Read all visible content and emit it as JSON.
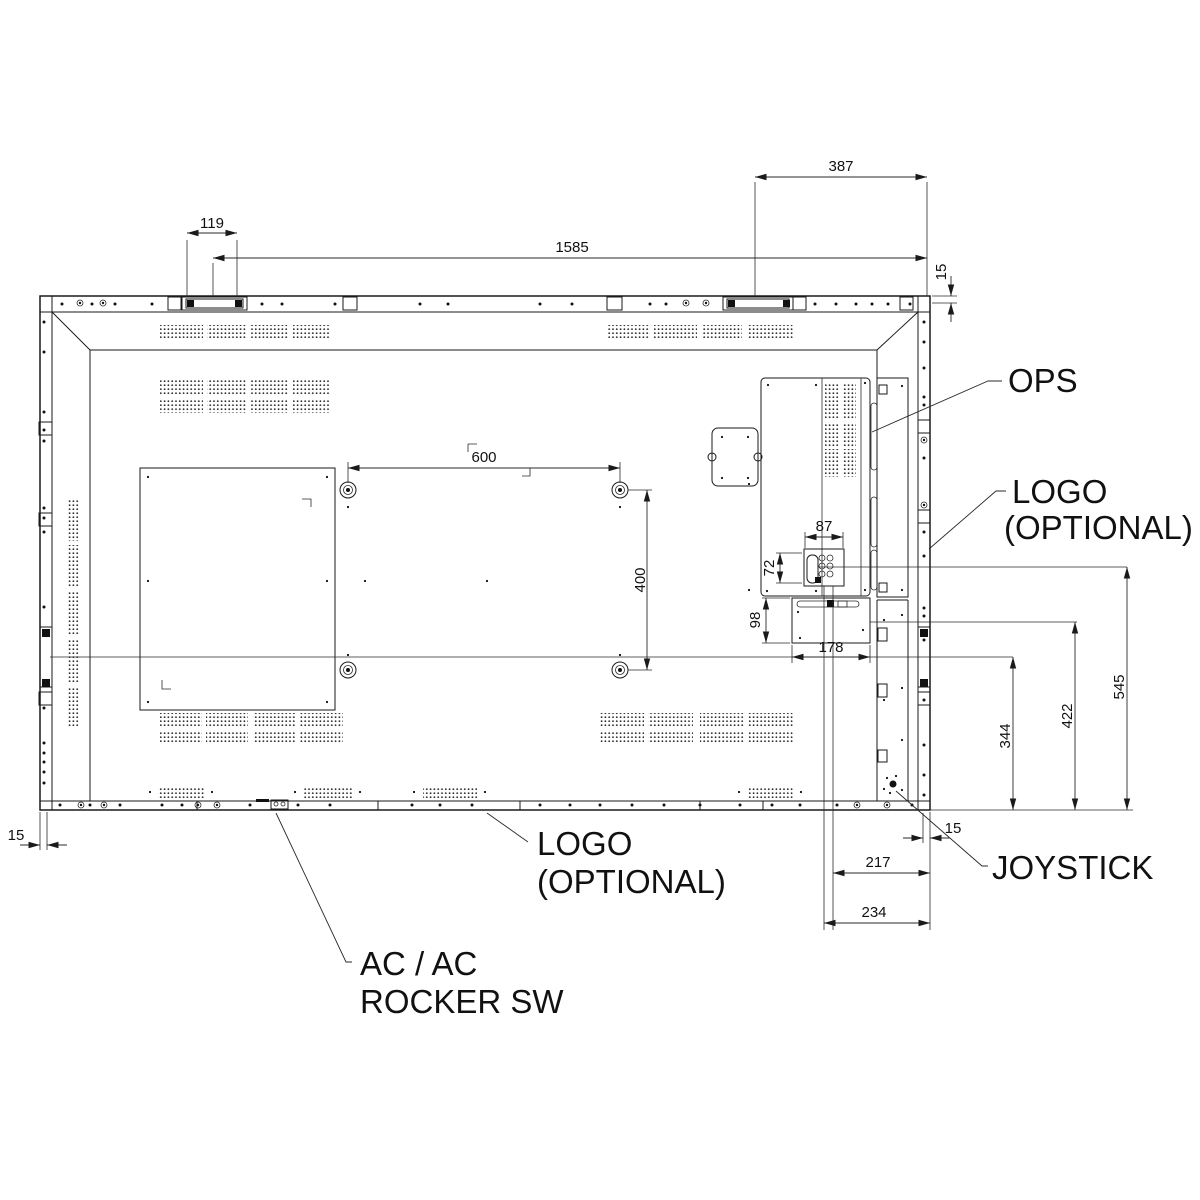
{
  "drawing": {
    "background": "#ffffff",
    "line_color": "#1a1a1a",
    "dimensions": {
      "handle_width": "119",
      "overall_width": "1585",
      "top_right_offset": "387",
      "top_edge_margin": "15",
      "vesa_horizontal": "600",
      "vesa_vertical": "400",
      "control_width": "87",
      "control_height": "72",
      "box_height": "98",
      "box_width": "178",
      "height_545": "545",
      "height_422": "422",
      "height_344": "344",
      "left_edge_margin": "15",
      "joystick_edge_margin": "15",
      "offset_217": "217",
      "offset_234": "234"
    },
    "labels": {
      "ops": "OPS",
      "logo_right": {
        "line1": "LOGO",
        "line2": "(OPTIONAL)"
      },
      "logo_bottom": {
        "line1": "LOGO",
        "line2": "(OPTIONAL)"
      },
      "joystick": "JOYSTICK",
      "ac_rocker": {
        "line1": "AC / AC",
        "line2": "ROCKER SW"
      }
    }
  }
}
